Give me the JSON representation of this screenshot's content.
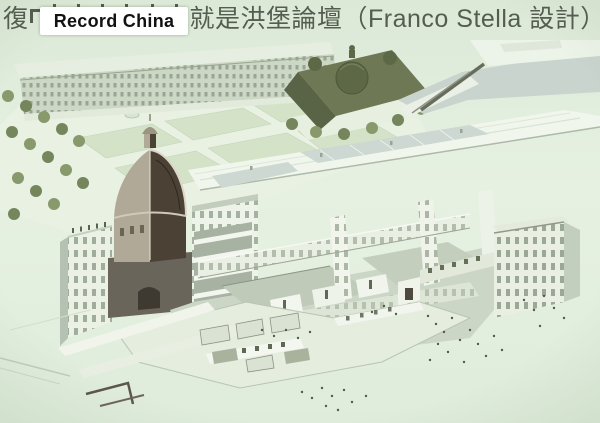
{
  "title": {
    "prefix": "復",
    "suffix": "就是洪堡論壇（Franco Stella 設計）"
  },
  "watermark": {
    "label": "Record China"
  },
  "palette": {
    "bg": "#e2eedd",
    "titleText": "#545d50",
    "wmBg": "#ffffff",
    "wmText": "#121212",
    "facade": "#ebf1e5",
    "facadeShade": "#b5c1b1",
    "window": "#8e9c88",
    "lawn": "#d3e3c6",
    "tree": "#87996a",
    "treeDark": "#74855a",
    "cath": "#6e7852",
    "cathDark": "#596344",
    "domeShell": "#b0a996",
    "domeDark": "#4b4134",
    "river": "#c8d4cd",
    "roof": "#f1f6ed",
    "courtFloor": "#bfcab8",
    "lineDark": "#5d564a",
    "people": "#515c49"
  }
}
